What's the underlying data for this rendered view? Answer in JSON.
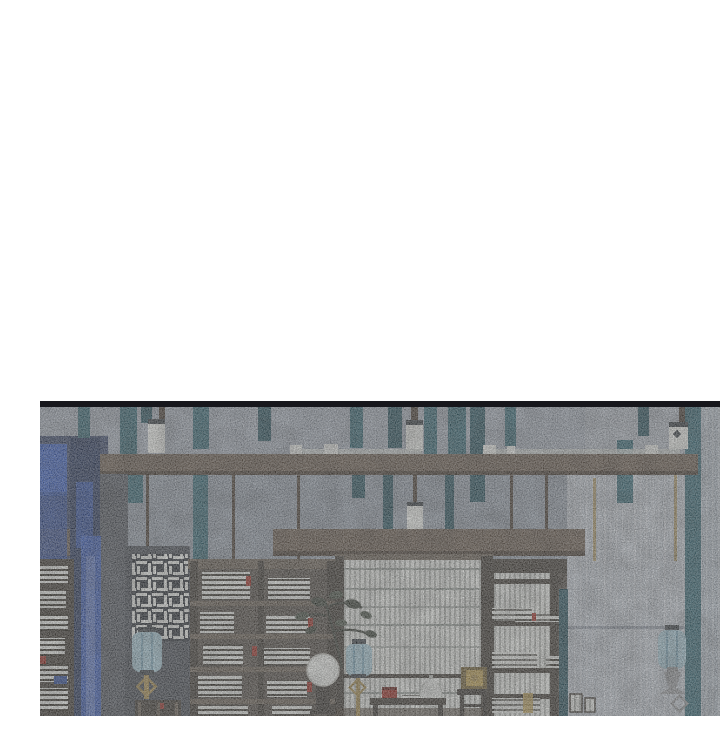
{
  "scene": {
    "kind": "webtoon-panel-illustration",
    "description": "Grainy illustrated interior of a traditional East Asian study: teal banners hang from a grey ceiling over a dark wooden beam with small white lanterns; below are a blue curtain, lattice screens, bookshelves stacked with white books, a large white slatted window, blue cloth lanterns, a bonsai, and a low table with a red box, white jar and gilded chest. The top half of the panel is blank white above a black rule.",
    "objects": [
      {
        "name": "blank-top-area",
        "color_ref": "paper"
      },
      {
        "name": "panel-divider-rule",
        "color_ref": "ink"
      },
      {
        "name": "ceiling",
        "color_ref": "ceiling"
      },
      {
        "name": "hanging-teal-banners",
        "color_ref": "teal"
      },
      {
        "name": "white-ceiling-lanterns",
        "color_ref": "white",
        "count": 4
      },
      {
        "name": "main-wooden-beam",
        "color_ref": "beam"
      },
      {
        "name": "second-wooden-beam",
        "color_ref": "beam"
      },
      {
        "name": "blue-curtain",
        "color_refs": [
          "navy",
          "blue"
        ]
      },
      {
        "name": "left-bookshelf",
        "color_refs": [
          "woodd",
          "white"
        ]
      },
      {
        "name": "fret-lattice-screen",
        "color_refs": [
          "lattd",
          "white"
        ]
      },
      {
        "name": "center-bookshelf",
        "color_refs": [
          "wood",
          "white",
          "red"
        ]
      },
      {
        "name": "bonsai-plant",
        "color_refs": [
          "branch",
          "leaf"
        ]
      },
      {
        "name": "large-slatted-window",
        "color_refs": [
          "white",
          "windowgap"
        ]
      },
      {
        "name": "side-lattice-shelf",
        "color_refs": [
          "woodd",
          "white",
          "gold"
        ]
      },
      {
        "name": "right-panelled-wall",
        "color_refs": [
          "wallright",
          "wallfar"
        ]
      },
      {
        "name": "blue-cloth-lanterns",
        "color_ref": "lanternblue",
        "count": 3
      },
      {
        "name": "moon-disc-on-stand",
        "color_ref": "white"
      },
      {
        "name": "low-table-with-red-box-books-jar",
        "color_refs": [
          "woodd",
          "red",
          "white"
        ]
      },
      {
        "name": "gilded-chest-on-stand",
        "color_refs": [
          "gold",
          "goldbright"
        ]
      }
    ]
  },
  "palette": {
    "paper": "#ffffff",
    "ink": "#17171c",
    "ceiling": "#a7afba",
    "wall": "#98a1ac",
    "walllow": "#8d96a1",
    "wallright": "#c1c8d0",
    "wallfar": "#b6c0ca",
    "teal": "#396b78",
    "teald": "#2c5561",
    "beam": "#6e6053",
    "beamd": "#4b4036",
    "beaml": "#cfd3d0",
    "navy": "#2b3a5e",
    "blue": "#3f63c1",
    "blued": "#33519f",
    "pillar": "#575c64",
    "wood": "#6e6458",
    "woodd": "#423d36",
    "shelfback": "#57514a",
    "paneld": "#4b5058",
    "lattd": "#2e333a",
    "white": "#eef0ec",
    "windowgap": "#bcbfba",
    "windowline": "#9aa09b",
    "lanternblue": "#a9cbd8",
    "lanternfold": "#7fa9bc",
    "capdark": "#3a4045",
    "gold": "#a98f52",
    "goldbright": "#c8a858",
    "red": "#a23127",
    "leaf": "#4e574b",
    "leafdark": "#3d443a",
    "branch": "#3c4038",
    "stand": "#3c3833",
    "metal": "#9a9c9e"
  }
}
